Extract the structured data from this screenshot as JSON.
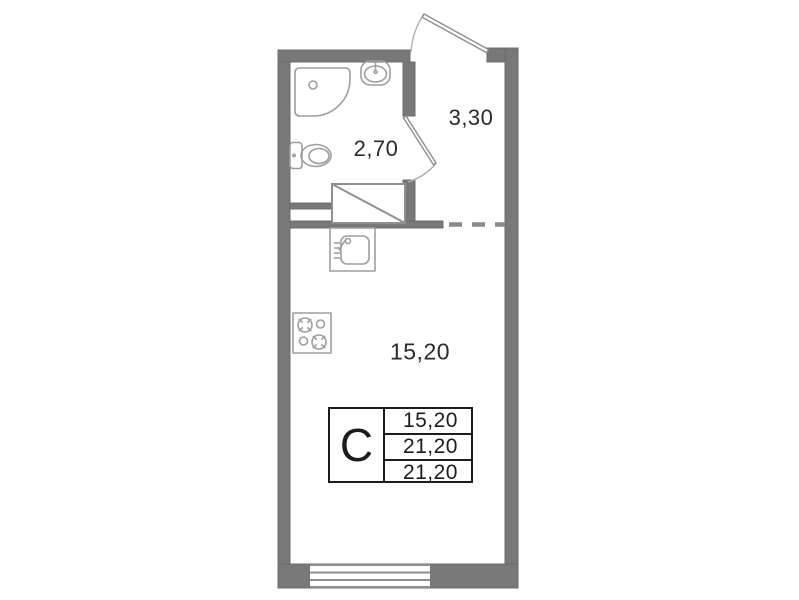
{
  "plan": {
    "labels": {
      "bathroom_area": "2,70",
      "hall_area": "3,30",
      "room_area": "15,20"
    },
    "legend": {
      "unit_type": "С",
      "values": [
        "15,20",
        "21,20",
        "21,20"
      ]
    },
    "colors": {
      "wall": "#787878",
      "wall_edge": "#6d6d6d",
      "fixture": "#9e9e9e",
      "door": "#8f8f8f",
      "dash": "#8a8a8a",
      "text": "#2b2b2b",
      "table_border": "#1c1c1c",
      "background": "#ffffff"
    }
  }
}
